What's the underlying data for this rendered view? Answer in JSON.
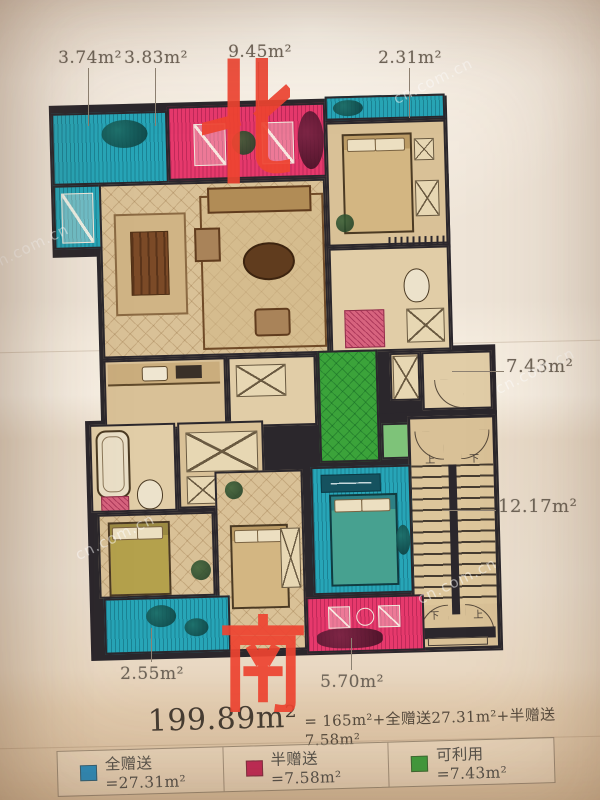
{
  "poster": {
    "compass": {
      "north": "北",
      "south": "南"
    },
    "area_labels": {
      "top_left_1": "3.74m²",
      "top_left_2": "3.83m²",
      "top_mid": "9.45m²",
      "top_right": "2.31m²",
      "right_upper": "7.43m²",
      "right_lower": "12.17m²",
      "bottom_left": "2.55m²",
      "bottom_mid": "5.70m²"
    },
    "formula": {
      "total": "199.89m²",
      "breakdown": "= 165m²+全赠送27.31m²+半赠送7.58m²"
    },
    "legend": [
      {
        "label": "全赠送=27.31m²",
        "color": "#2a8dbd"
      },
      {
        "label": "半赠送=7.58m²",
        "color": "#c22a56"
      },
      {
        "label": "可利用=7.43m²",
        "color": "#3f9e3d"
      }
    ],
    "stairs": {
      "down": "下",
      "up": "上"
    },
    "colors": {
      "full_giveaway_zone": "#2aa4b6",
      "half_giveaway_zone": "#e23a6c",
      "usable_zone": "#3da23c",
      "compass_red": "#ee4431"
    }
  },
  "watermark": {
    "text": "cn.com.cn"
  }
}
